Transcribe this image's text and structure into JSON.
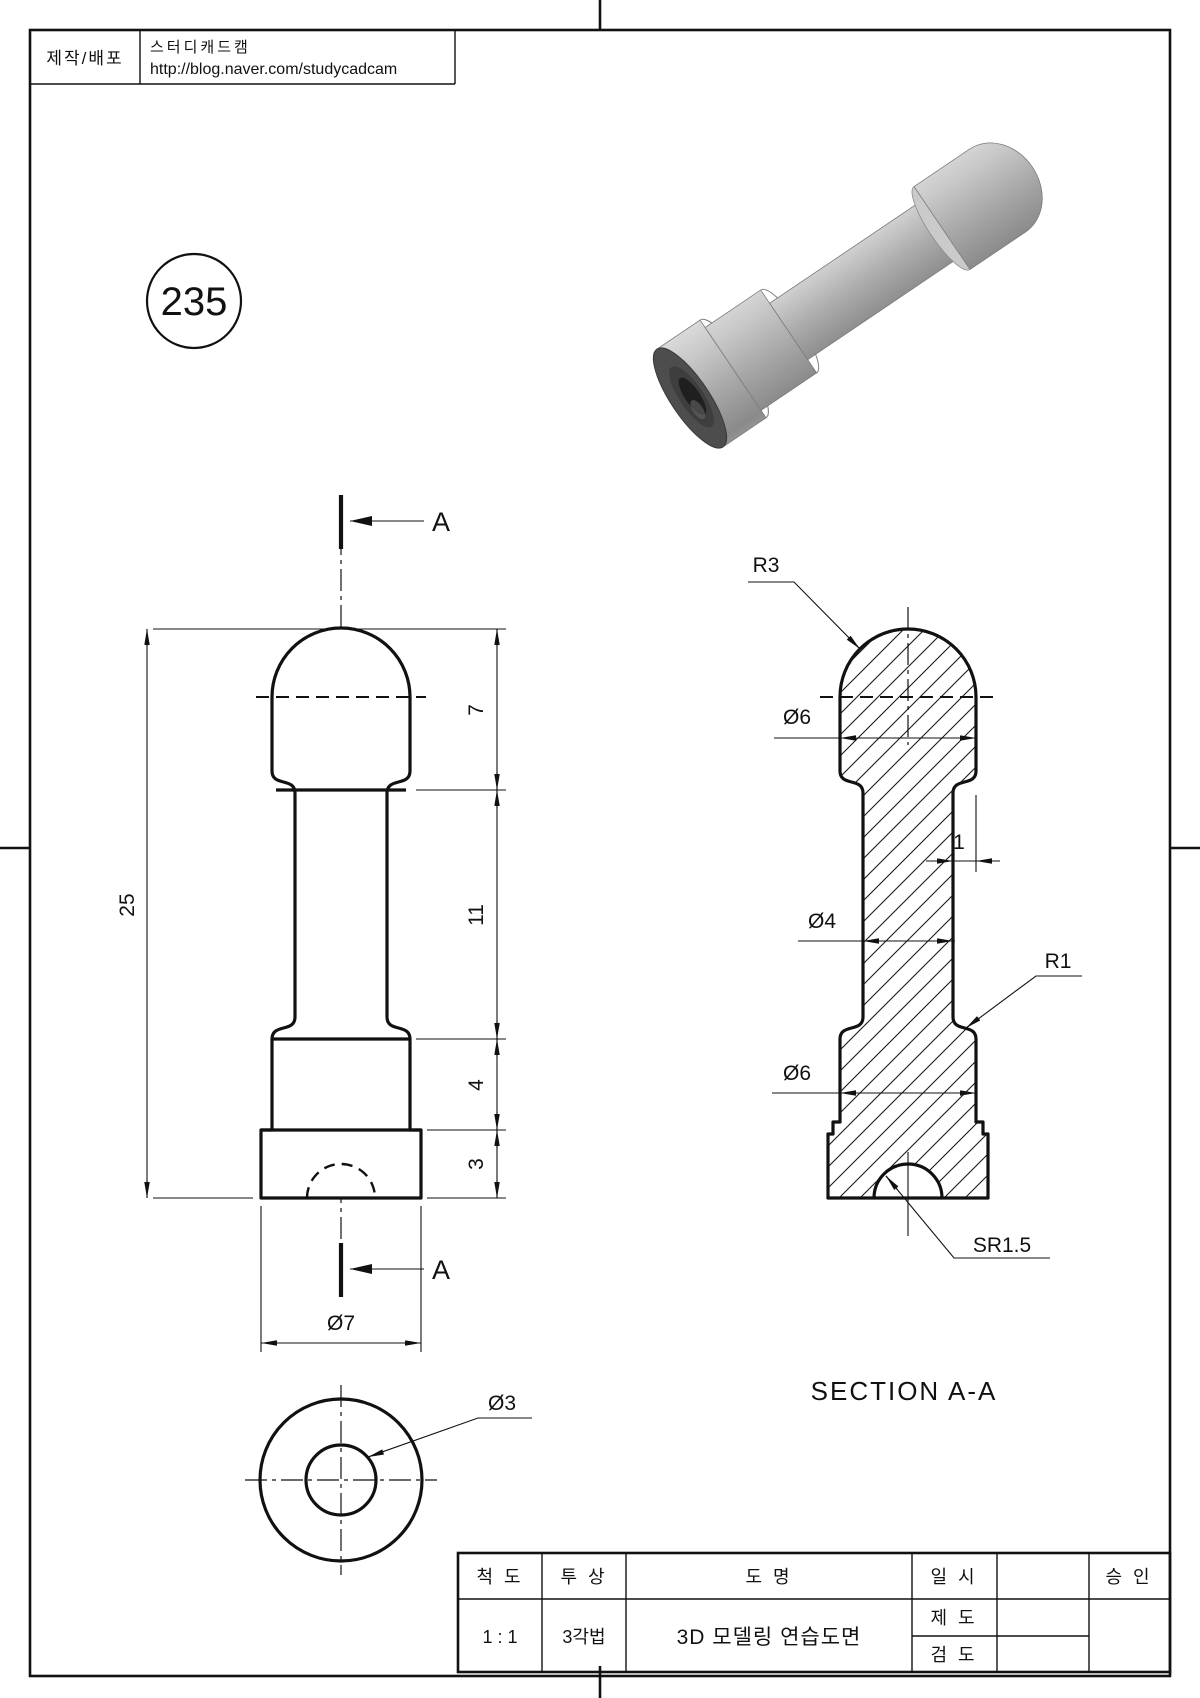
{
  "header": {
    "label": "제작/배포",
    "line1": "스터디캐드캠",
    "line2": "http://blog.naver.com/studycadcam"
  },
  "drawing_number": "235",
  "front_view": {
    "section_label_top": "A",
    "section_label_bottom": "A",
    "dim_overall": "25",
    "dim_head": "7",
    "dim_neck": "11",
    "dim_collar": "4",
    "dim_base": "3",
    "dim_base_dia": "Ø7",
    "dim_hole_dia": "Ø3"
  },
  "section_view": {
    "title": "SECTION A-A",
    "dim_head_radius": "R3",
    "dim_head_dia": "Ø6",
    "dim_step": "1",
    "dim_neck_dia": "Ø4",
    "dim_fillet": "R1",
    "dim_collar_dia": "Ø6",
    "dim_recess": "SR1.5"
  },
  "title_block": {
    "scale_label": "척 도",
    "scale_value": "1 : 1",
    "projection_label": "투 상",
    "projection_value": "3각법",
    "name_label": "도 명",
    "name_value": "3D 모델링 연습도면",
    "date_label": "일 시",
    "draft_label": "제 도",
    "check_label": "검 도",
    "approve_label": "승 인"
  }
}
